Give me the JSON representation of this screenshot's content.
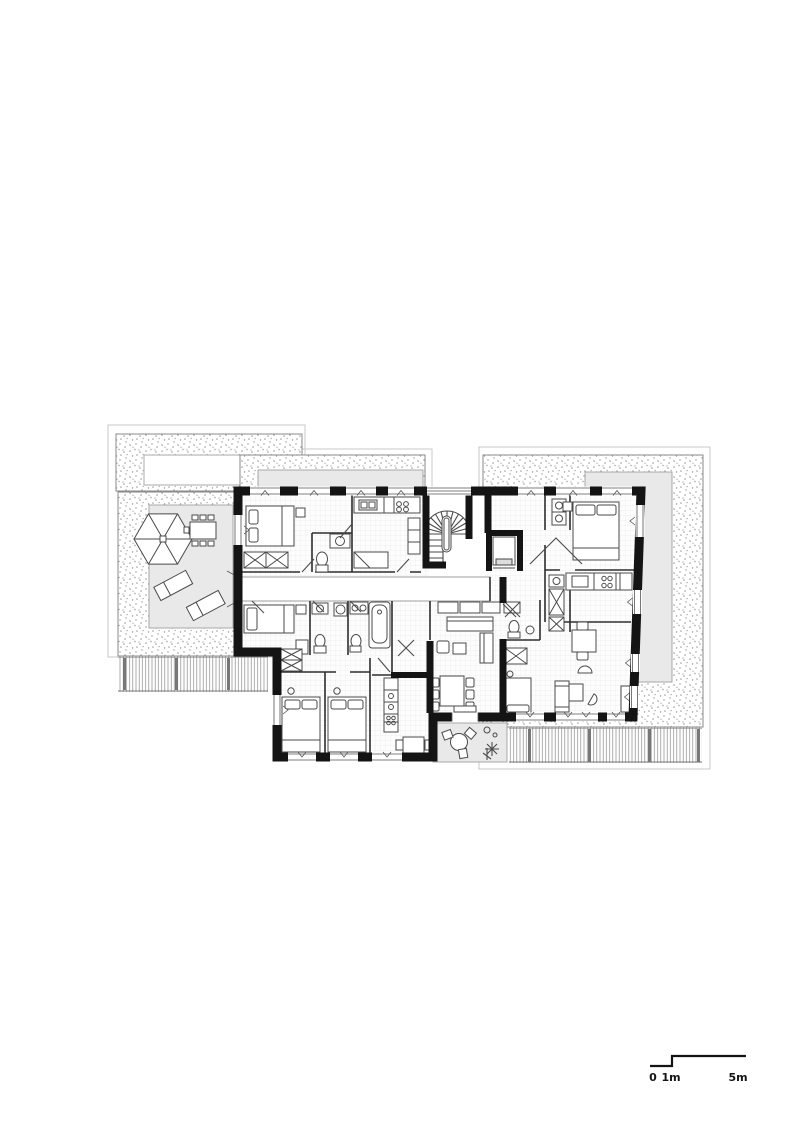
{
  "scale_bar": {
    "zero": "0",
    "one_meter": "1m",
    "five_meters": "5m"
  },
  "colors": {
    "paper": "#ffffff",
    "wall": "#141414",
    "thin": "#4a4a4a",
    "faint": "#c8c8c8",
    "deck": "#e9e9e9",
    "deckline": "#a8a8a8",
    "rail": "#8a8a8a",
    "gravel": "#9a9a9a",
    "grid": "#e8e8e8"
  },
  "icons": {
    "parasol-icon": "hexagon-with-spokes",
    "dining-table-icon": "rect-with-chairs",
    "sun-lounger-icon": "tilted-rect",
    "spiral-stair-icon": "semicircle-fan",
    "elevator-icon": "u-shaft-with-car",
    "bed-icon": "rect-with-pillows",
    "bathtub-icon": "rounded-rect",
    "toilet-icon": "ellipse-with-tank",
    "wardrobe-icon": "box-with-x",
    "round-table-icon": "circle-with-chairs",
    "plant-icon": "asterisk",
    "scale-bar-icon": "stepped-line"
  }
}
